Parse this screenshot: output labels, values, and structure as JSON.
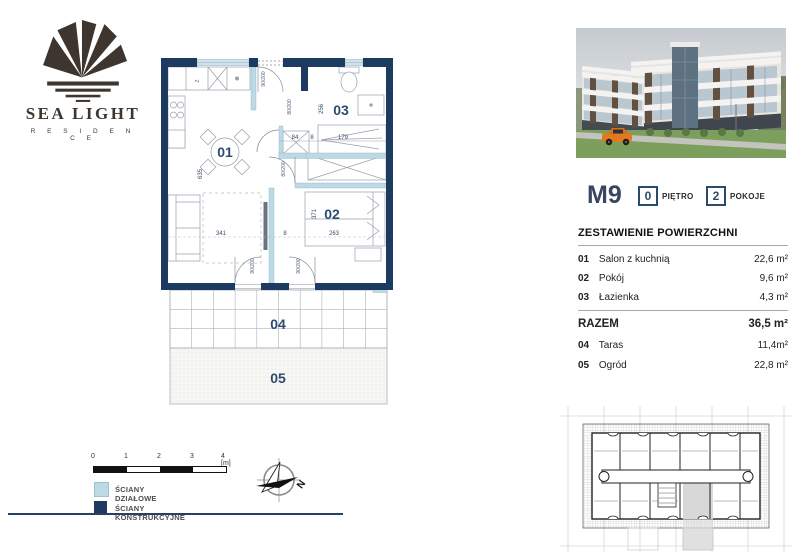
{
  "logo": {
    "name": "SEA LIGHT",
    "tagline": "R E S I D E N C E"
  },
  "unit_header": {
    "code": "M9",
    "floor_number": "0",
    "floor_label": "PIĘTRO",
    "rooms_number": "2",
    "rooms_label": "POKOJE"
  },
  "area_table": {
    "title": "ZESTAWIENIE POWIERZCHNI",
    "rows": [
      {
        "no": "01",
        "name": "Salon z kuchnią",
        "value": "22,6 m²"
      },
      {
        "no": "02",
        "name": "Pokój",
        "value": "9,6 m²"
      },
      {
        "no": "03",
        "name": "Łazienka",
        "value": "4,3 m²"
      }
    ],
    "total_label": "RAZEM",
    "total_value": "36,5 m²",
    "extra_rows": [
      {
        "no": "04",
        "name": "Taras",
        "value": "11,4m²"
      },
      {
        "no": "05",
        "name": "Ogród",
        "value": "22,8 m²"
      }
    ]
  },
  "floor_plan": {
    "rooms": [
      {
        "id": "01"
      },
      {
        "id": "02"
      },
      {
        "id": "03"
      },
      {
        "id": "04"
      },
      {
        "id": "05"
      }
    ],
    "dims": {
      "d635": "635",
      "d341": "341",
      "d8a": "8",
      "d263": "263",
      "d371": "371",
      "d84": "84",
      "d8b": "8",
      "d179": "179",
      "d256": "256",
      "door_entrance": "90/200",
      "door_bath": "80/200",
      "door_bedroom": "80/200",
      "door_terrace1": "90/200",
      "door_terrace2": "90/200",
      "kitchen_appliance": "Z"
    }
  },
  "legend": {
    "scale_labels": [
      "0",
      "1",
      "2",
      "3",
      "4 [m]"
    ],
    "items": [
      {
        "label": "ŚCIANY DZIAŁOWE"
      },
      {
        "label": "ŚCIANY KONSTRUKCYJNE"
      }
    ]
  },
  "compass": {
    "north": "N"
  },
  "colors": {
    "wall_structural": "#1d3a60",
    "wall_partition": "#bcd9e6",
    "accent_navy": "#2e4a6b",
    "highlight_gray": "#d8d8d8"
  }
}
